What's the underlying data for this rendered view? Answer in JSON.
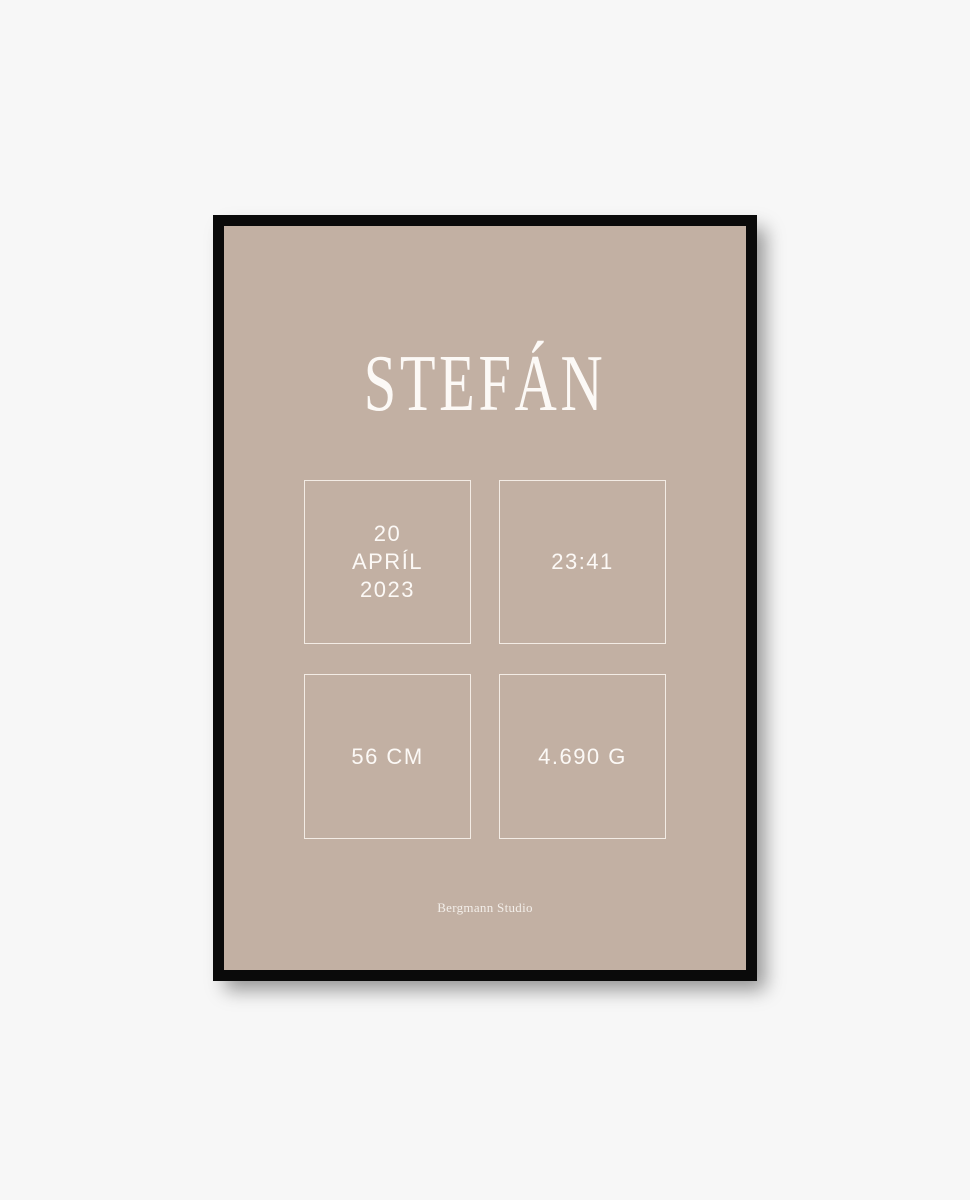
{
  "page": {
    "background": "#f7f7f7"
  },
  "poster": {
    "title": "STEFÁN",
    "stats": [
      {
        "id": "birth-date",
        "lines": [
          "20",
          "APRÍL",
          "2023"
        ]
      },
      {
        "id": "birth-time",
        "lines": [
          "23:41"
        ]
      },
      {
        "id": "birth-length",
        "lines": [
          "56 CM"
        ]
      },
      {
        "id": "birth-weight",
        "lines": [
          "4.690 G"
        ]
      }
    ],
    "brand": "Bergmann Studio",
    "colors": {
      "page_bg": "#f7f7f7",
      "frame": "#0a0a0a",
      "poster_bg": "#c2b0a3",
      "text": "#fcf9f6",
      "box_border": "#f3ece5"
    }
  }
}
